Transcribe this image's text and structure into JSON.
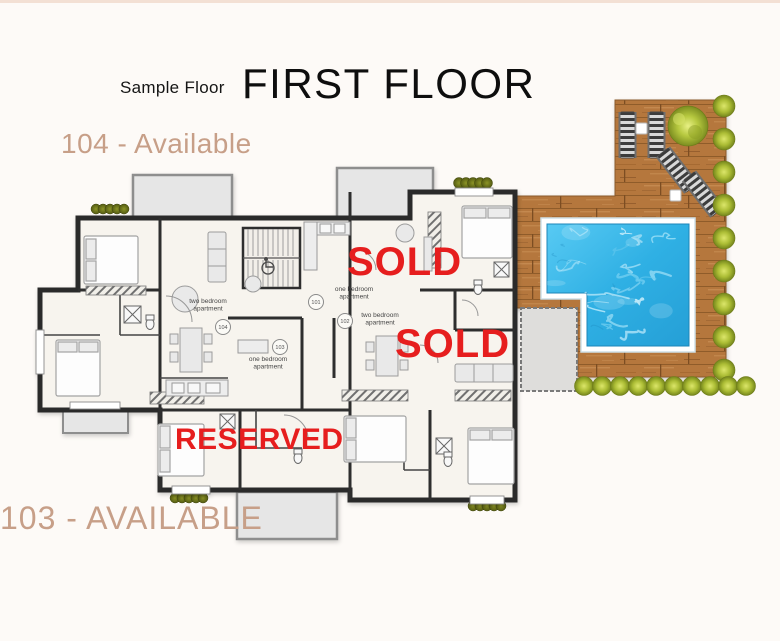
{
  "header": {
    "subtitle": "Sample Floor",
    "title": "FIRST FLOOR"
  },
  "status_labels": {
    "apt104": {
      "text": "104 - Available"
    },
    "sold_top": {
      "text": "SOLD"
    },
    "sold_mid": {
      "text": "SOLD"
    },
    "reserved": {
      "text": "RESERVED"
    },
    "apt103": {
      "text": "103 - AVAILABLE"
    }
  },
  "floorplan": {
    "apartment_type_labels": [
      {
        "line1": "two bedroom",
        "line2": "apartment",
        "x": 208,
        "y": 303
      },
      {
        "line1": "one bedroom",
        "line2": "apartment",
        "x": 354,
        "y": 291
      },
      {
        "line1": "two bedroom",
        "line2": "apartment",
        "x": 380,
        "y": 317
      },
      {
        "line1": "one bedroom",
        "line2": "apartment",
        "x": 268,
        "y": 361
      }
    ],
    "unit_markers": [
      {
        "number": "104",
        "x": 223,
        "y": 327
      },
      {
        "number": "101",
        "x": 316,
        "y": 302
      },
      {
        "number": "102",
        "x": 345,
        "y": 321
      },
      {
        "number": "103",
        "x": 280,
        "y": 347
      }
    ]
  },
  "colors": {
    "accent_tan": "#c79f88",
    "status_red": "#e61e1e",
    "water_blue": "#2fb0e4",
    "deck_wood": "#b5773e",
    "bush_green": "#acbd35"
  }
}
